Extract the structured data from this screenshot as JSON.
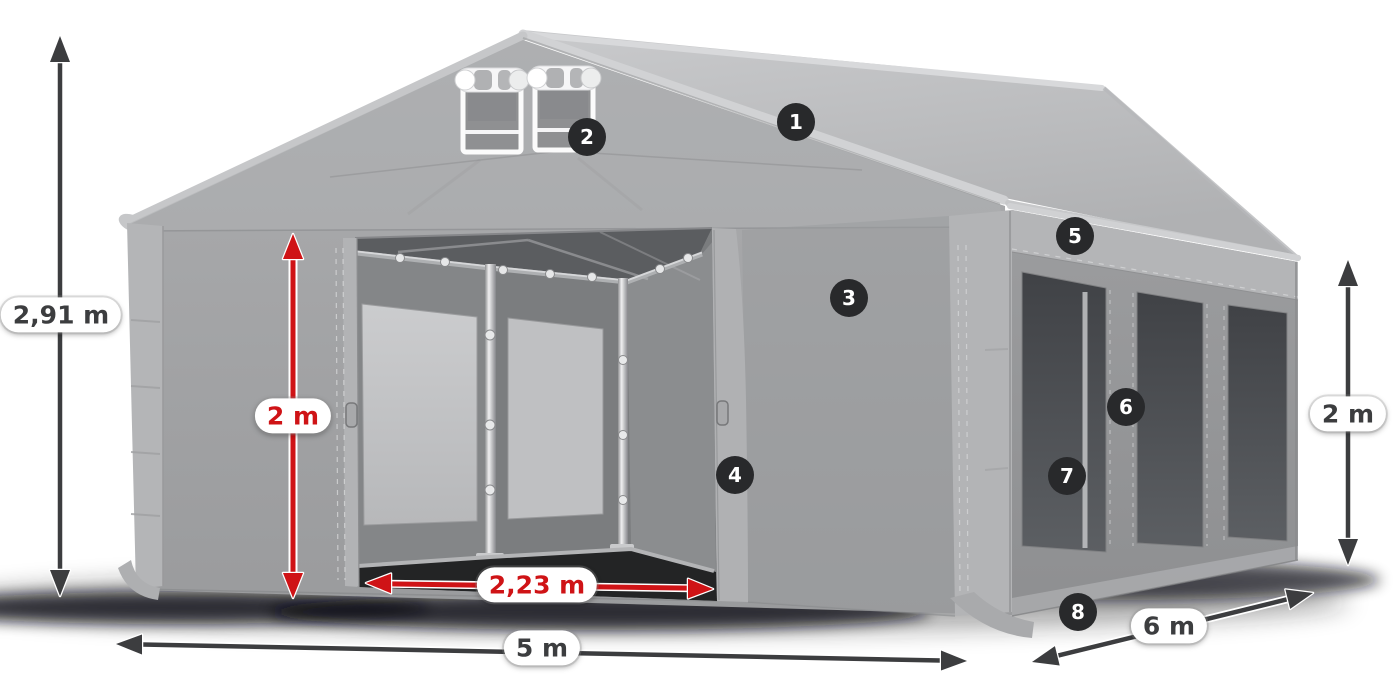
{
  "colors": {
    "accent_red": "#cf1316",
    "dimension_dark": "#3c3d3f",
    "badge_bg": "#28292b",
    "background": "#ffffff",
    "tent_light_gray": "#b9babc",
    "tent_mid_gray": "#a3a4a6",
    "window_dark_gray": "#46484c"
  },
  "dimension_labels": {
    "total_height": "2,91 m",
    "entrance_height": "2 m",
    "entrance_width": "2,23 m",
    "front_width": "5 m",
    "side_length": "6 m",
    "side_wall_height": "2 m"
  },
  "callouts": [
    {
      "number": "1"
    },
    {
      "number": "2"
    },
    {
      "number": "3"
    },
    {
      "number": "4"
    },
    {
      "number": "5"
    },
    {
      "number": "6"
    },
    {
      "number": "7"
    },
    {
      "number": "8"
    }
  ]
}
